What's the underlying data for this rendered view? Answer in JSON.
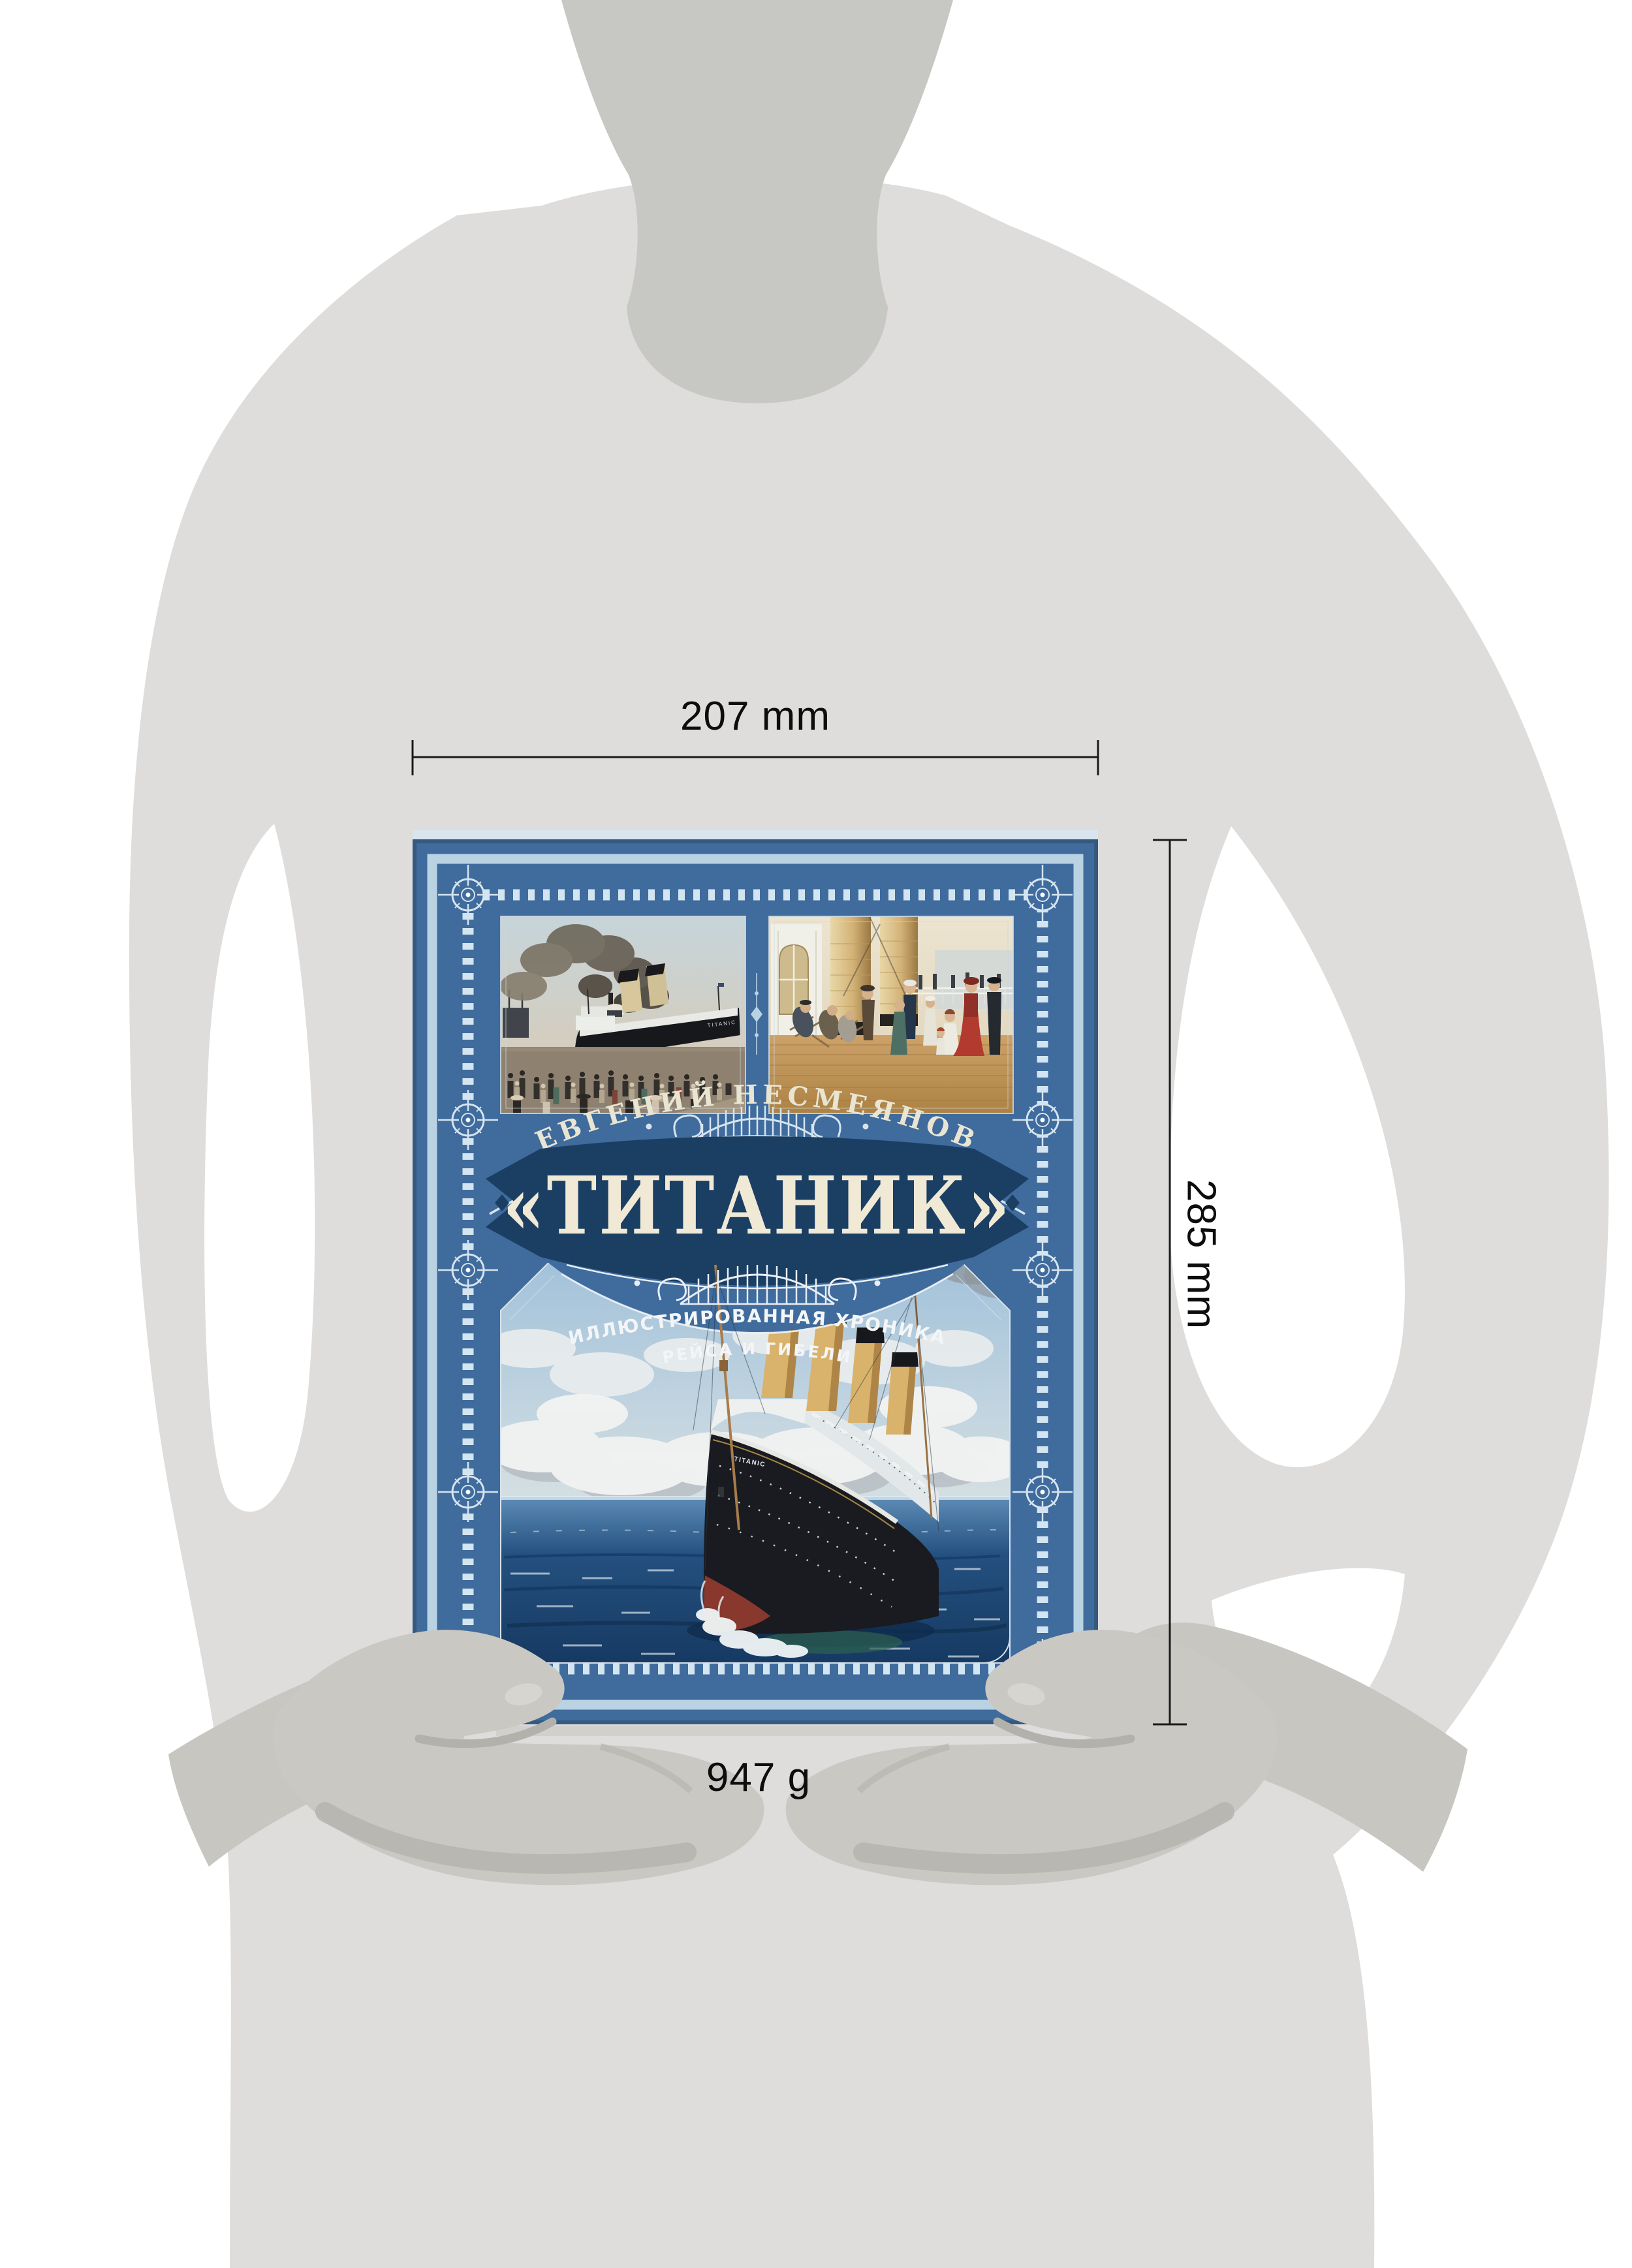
{
  "annotations": {
    "width_label": "207 mm",
    "height_label": "285 mm",
    "weight_label": "947 g"
  },
  "book": {
    "author": "ЕВГЕНИЙ НЕСМЕЯНОВ",
    "title": "«ТИТАНИК»",
    "subtitle_line1": "ИЛЛЮСТРИРОВАННАЯ ХРОНИКА",
    "subtitle_line2": "РЕЙСА И ГИБЕЛИ",
    "bow_name": "TITANIC"
  },
  "colors": {
    "cover_blue": "#3f6b9d",
    "banner_navy": "#1b3e63",
    "frame_light_blue": "#b9d3e3",
    "tick_light": "#d2e5f0",
    "title_cream": "#f0e9d6",
    "silhouette_body": "#dedddc",
    "silhouette_neck": "#c7c7c3",
    "hand_gray": "#cac8c3",
    "dimension_line": "#1a1a1a"
  }
}
